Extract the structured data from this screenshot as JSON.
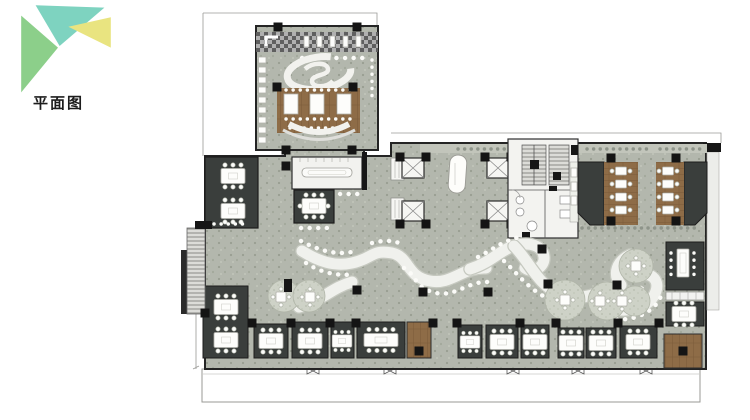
{
  "title": {
    "label": "平面图"
  },
  "logo": {
    "colors": {
      "top": "#7ed3c0",
      "left": "#8ccf8a",
      "right": "#e9e480"
    }
  },
  "plan": {
    "colors": {
      "floor": "#b3b7ad",
      "wall": "#242424",
      "dark_room": "#3a3e3c",
      "wood": "#8e6c47",
      "white_surface": "#f2f2ef",
      "boundary": "#9a9a96",
      "seating_circle": "#ced2c7",
      "column": "#141414"
    }
  }
}
